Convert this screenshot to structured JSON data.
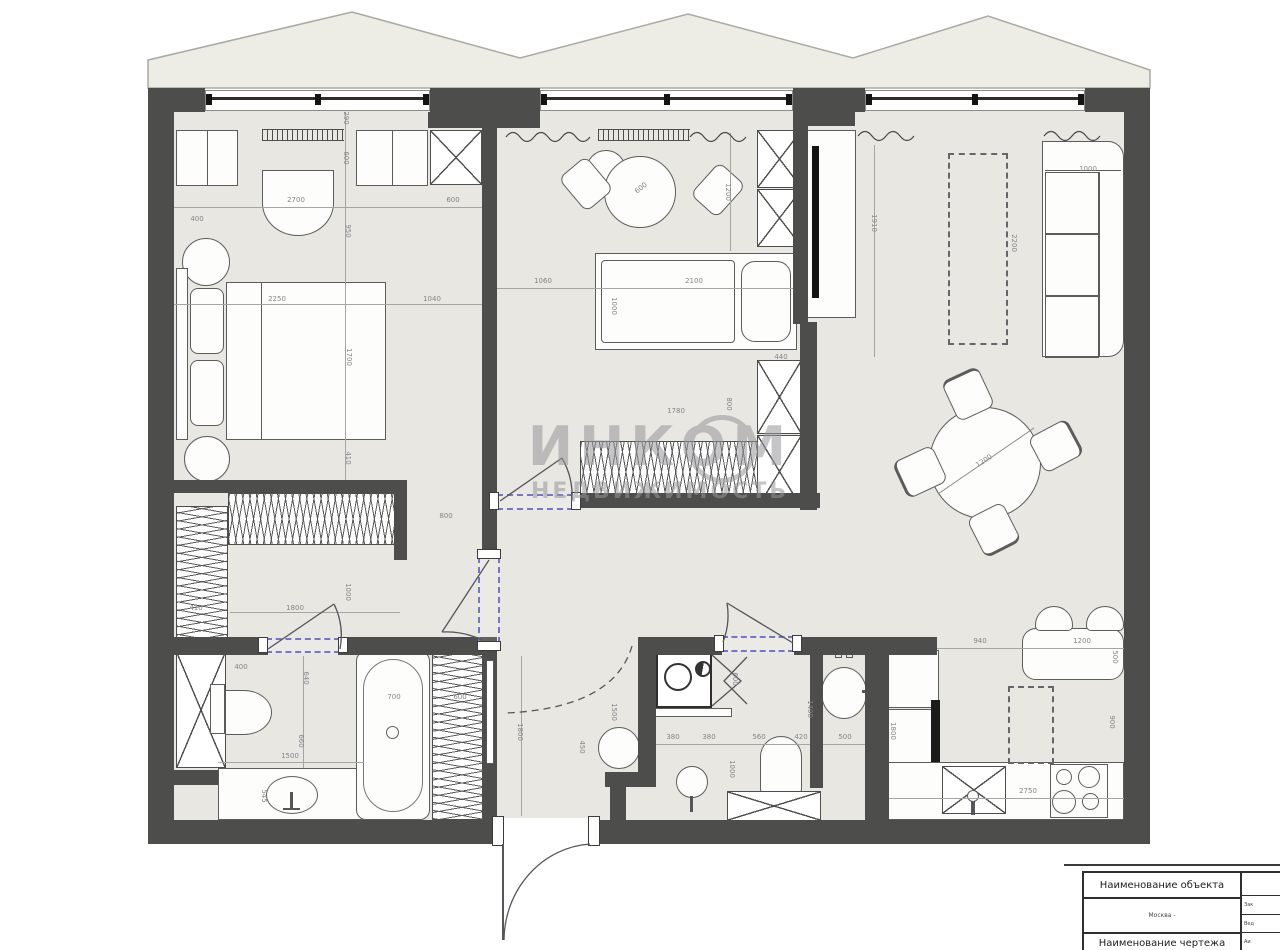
{
  "watermark": {
    "line1": "ИНКОМ",
    "line2": "НЕДВИЖИМОСТЬ"
  },
  "title_block": {
    "header": "Наименование объекта",
    "subheader": "Москва -",
    "footer": "Наименование чертежа",
    "side_cells": [
      "Зак",
      "Вед",
      "Аи"
    ]
  },
  "colors": {
    "wall": "#4d4d4b",
    "floor": "#e9e7e1",
    "balcony": "#edece5",
    "dimension_text": "#84848a",
    "door_opening_dash": "#7575cd",
    "appliance_black": "#141414"
  },
  "dimensions": [
    {
      "t": "290",
      "x": 346,
      "y": 118,
      "r": 90
    },
    {
      "t": "600",
      "x": 346,
      "y": 158,
      "r": 90
    },
    {
      "t": "2700",
      "x": 296,
      "y": 200,
      "r": 0
    },
    {
      "t": "400",
      "x": 197,
      "y": 219,
      "r": 0
    },
    {
      "t": "950",
      "x": 348,
      "y": 231,
      "r": 90
    },
    {
      "t": "600",
      "x": 453,
      "y": 200,
      "r": 0
    },
    {
      "t": "2250",
      "x": 277,
      "y": 299,
      "r": 0
    },
    {
      "t": "1040",
      "x": 432,
      "y": 299,
      "r": 0
    },
    {
      "t": "1700",
      "x": 349,
      "y": 357,
      "r": 90
    },
    {
      "t": "410",
      "x": 348,
      "y": 458,
      "r": 90
    },
    {
      "t": "800",
      "x": 446,
      "y": 516,
      "r": 0
    },
    {
      "t": "1000",
      "x": 348,
      "y": 592,
      "r": 90
    },
    {
      "t": "410",
      "x": 196,
      "y": 608,
      "r": 0
    },
    {
      "t": "1800",
      "x": 295,
      "y": 608,
      "r": 0
    },
    {
      "t": "600",
      "x": 641,
      "y": 188,
      "r": -38
    },
    {
      "t": "1200",
      "x": 728,
      "y": 192,
      "r": 90
    },
    {
      "t": "1060",
      "x": 543,
      "y": 281,
      "r": 0
    },
    {
      "t": "2100",
      "x": 694,
      "y": 281,
      "r": 0
    },
    {
      "t": "1000",
      "x": 614,
      "y": 306,
      "r": 90
    },
    {
      "t": "440",
      "x": 781,
      "y": 357,
      "r": 0
    },
    {
      "t": "1780",
      "x": 676,
      "y": 411,
      "r": 0
    },
    {
      "t": "800",
      "x": 729,
      "y": 404,
      "r": 90
    },
    {
      "t": "1910",
      "x": 874,
      "y": 223,
      "r": 90
    },
    {
      "t": "2200",
      "x": 1014,
      "y": 243,
      "r": 90
    },
    {
      "t": "1000",
      "x": 1088,
      "y": 169,
      "r": 0
    },
    {
      "t": "1200",
      "x": 984,
      "y": 461,
      "r": -33
    },
    {
      "t": "940",
      "x": 980,
      "y": 641,
      "r": 0
    },
    {
      "t": "1200",
      "x": 1082,
      "y": 641,
      "r": 0
    },
    {
      "t": "500",
      "x": 1115,
      "y": 657,
      "r": 90
    },
    {
      "t": "900",
      "x": 1112,
      "y": 722,
      "r": 90
    },
    {
      "t": "1800",
      "x": 893,
      "y": 731,
      "r": 90
    },
    {
      "t": "2750",
      "x": 1028,
      "y": 791,
      "r": 0
    },
    {
      "t": "380",
      "x": 673,
      "y": 737,
      "r": 0
    },
    {
      "t": "380",
      "x": 709,
      "y": 737,
      "r": 0
    },
    {
      "t": "560",
      "x": 759,
      "y": 737,
      "r": 0
    },
    {
      "t": "420",
      "x": 801,
      "y": 737,
      "r": 0
    },
    {
      "t": "500",
      "x": 845,
      "y": 737,
      "r": 0
    },
    {
      "t": "1400",
      "x": 810,
      "y": 709,
      "r": 90
    },
    {
      "t": "1000",
      "x": 732,
      "y": 769,
      "r": 90
    },
    {
      "t": "600",
      "x": 735,
      "y": 679,
      "r": 90
    },
    {
      "t": "1800",
      "x": 520,
      "y": 732,
      "r": 90
    },
    {
      "t": "1500",
      "x": 614,
      "y": 712,
      "r": 90
    },
    {
      "t": "450",
      "x": 582,
      "y": 747,
      "r": 90
    },
    {
      "t": "400",
      "x": 241,
      "y": 667,
      "r": 0
    },
    {
      "t": "640",
      "x": 306,
      "y": 678,
      "r": 90
    },
    {
      "t": "660",
      "x": 301,
      "y": 741,
      "r": 90
    },
    {
      "t": "1500",
      "x": 290,
      "y": 756,
      "r": 0
    },
    {
      "t": "700",
      "x": 394,
      "y": 697,
      "r": 0
    },
    {
      "t": "600",
      "x": 460,
      "y": 697,
      "r": 0
    },
    {
      "t": "545",
      "x": 264,
      "y": 796,
      "r": 90
    }
  ]
}
